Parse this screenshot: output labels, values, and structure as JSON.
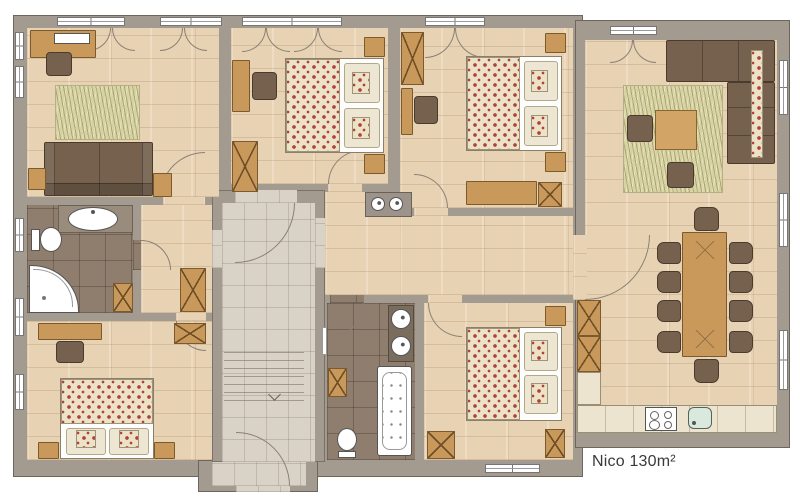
{
  "plan": {
    "label": "Nico 130m²",
    "colors": {
      "wall": "#a39a90",
      "wall_outline": "#6e665c",
      "wood_floor": "#e7d2b4",
      "tile_floor": "#d9d2c6",
      "bath_floor": "#8f7d6e",
      "wood_furniture": "#c9995c",
      "dark_furniture": "#75614e",
      "rug": "#d8d3a2",
      "floral_base": "#ece3c6",
      "floral_accent": "#b14040",
      "counter": "#ece4cf",
      "sink_green": "#d9e9dd",
      "fixture_white": "#ffffff",
      "text": "#3a3a3a"
    }
  }
}
